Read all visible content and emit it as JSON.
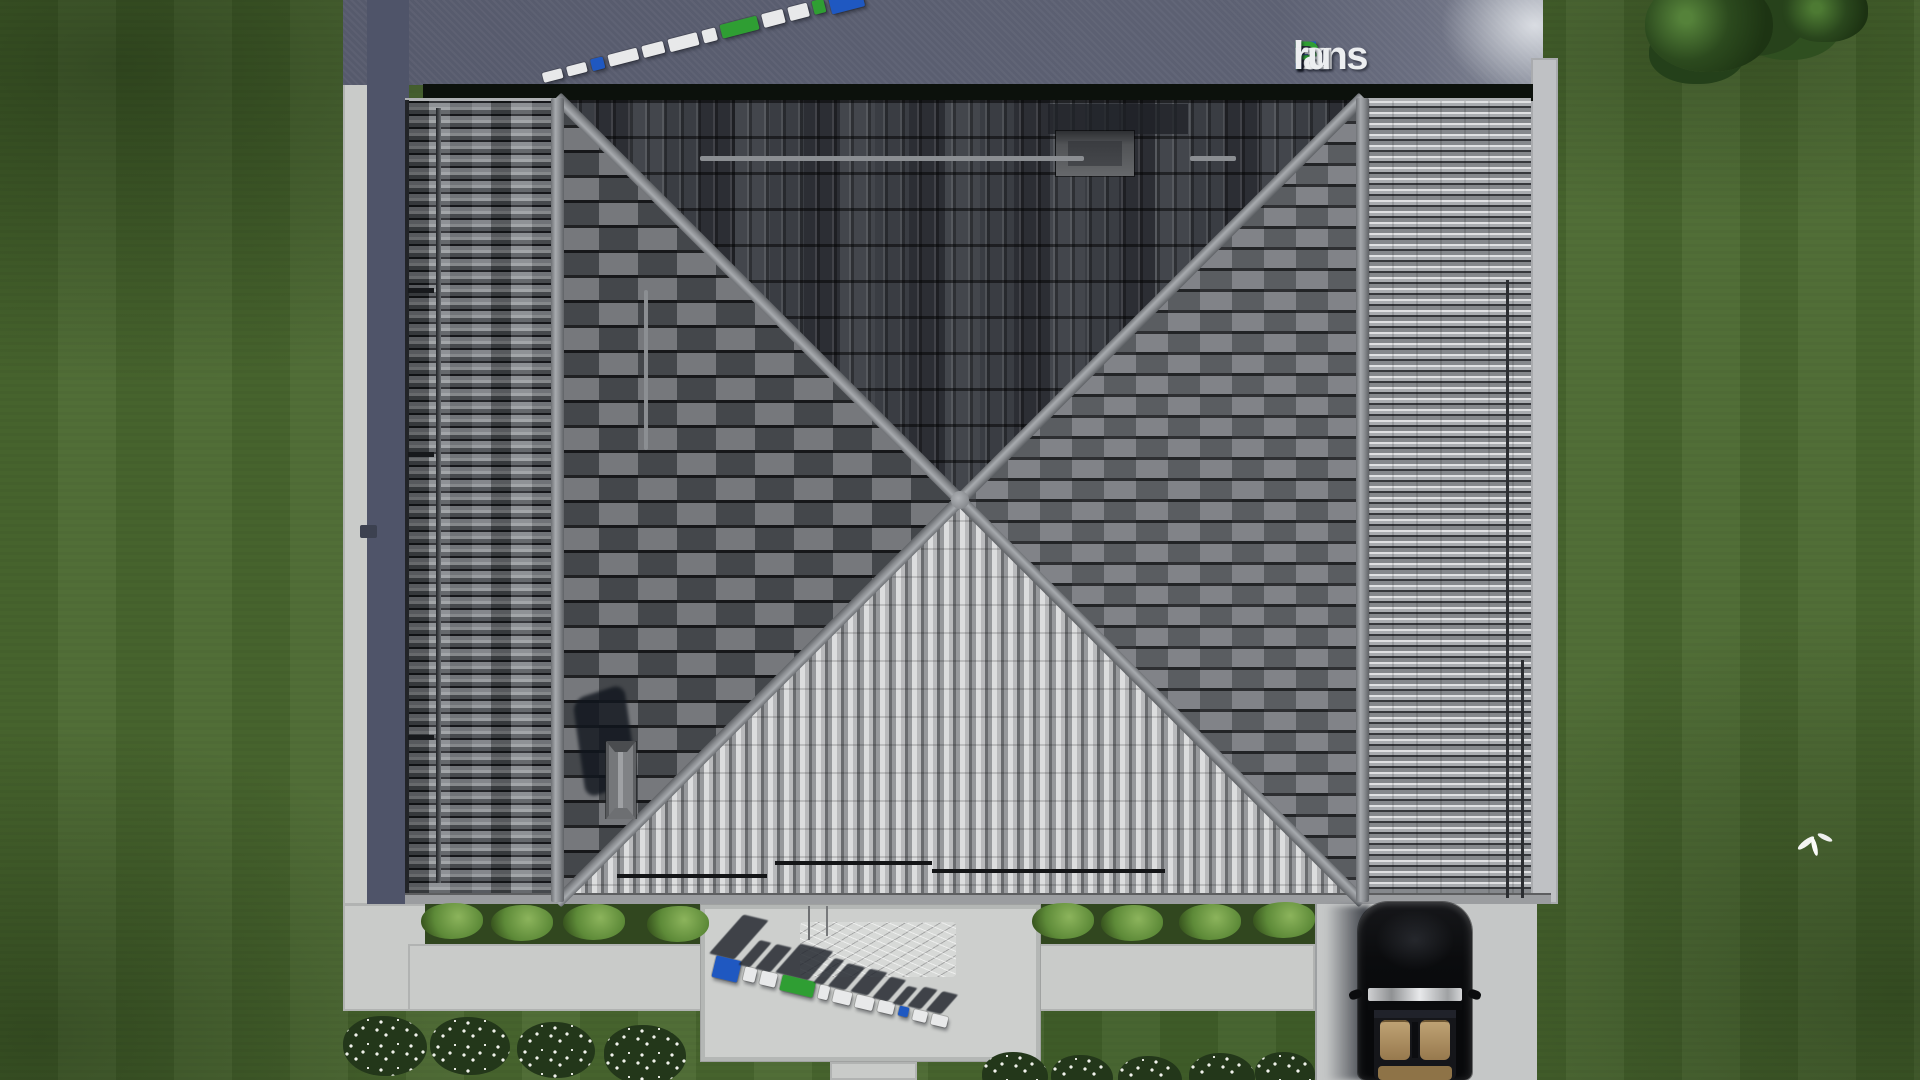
{
  "watermark": {
    "site_name": "FixPlans.ru",
    "logo_segments": [
      {
        "text": "F",
        "color": "#1f58c1"
      },
      {
        "text": "ix",
        "color": "#eceef0"
      },
      {
        "text": "P",
        "color": "#2f9e33"
      },
      {
        "text": "lans",
        "color": "#eceef0"
      },
      {
        "text": ".",
        "color": "#1f58c1"
      },
      {
        "text": "ru",
        "color": "#eceef0"
      }
    ],
    "slab_palette": {
      "white": "#e8e9ea",
      "blue": "#1f58c1",
      "green": "#2f9e33"
    },
    "slab_rows": {
      "top_reversed": [
        "white",
        "white",
        "blue",
        "white",
        "white",
        "white",
        "white",
        "green",
        "white",
        "white",
        "green",
        "blue"
      ],
      "bottom": [
        "blue",
        "white",
        "white",
        "green",
        "white",
        "white",
        "white",
        "white",
        "blue",
        "white",
        "white"
      ]
    }
  },
  "palette": {
    "grass": "#4a682f",
    "pavement_light": "#c9cbc9",
    "pavement_shadow": "#4f5469",
    "roof_dark_slope": "#33363c",
    "roof_mid_slope": "#5a5d62",
    "roof_bright_slope": "#b4b6b9",
    "ridge_gray": "#9a9da1",
    "eave_shadow": "#0c110c",
    "car_black": "#0a0b0d",
    "car_interior_tan": "#b59a6f",
    "hedge_green": "#6f9b4a",
    "flower_white": "#f2f3ee"
  }
}
